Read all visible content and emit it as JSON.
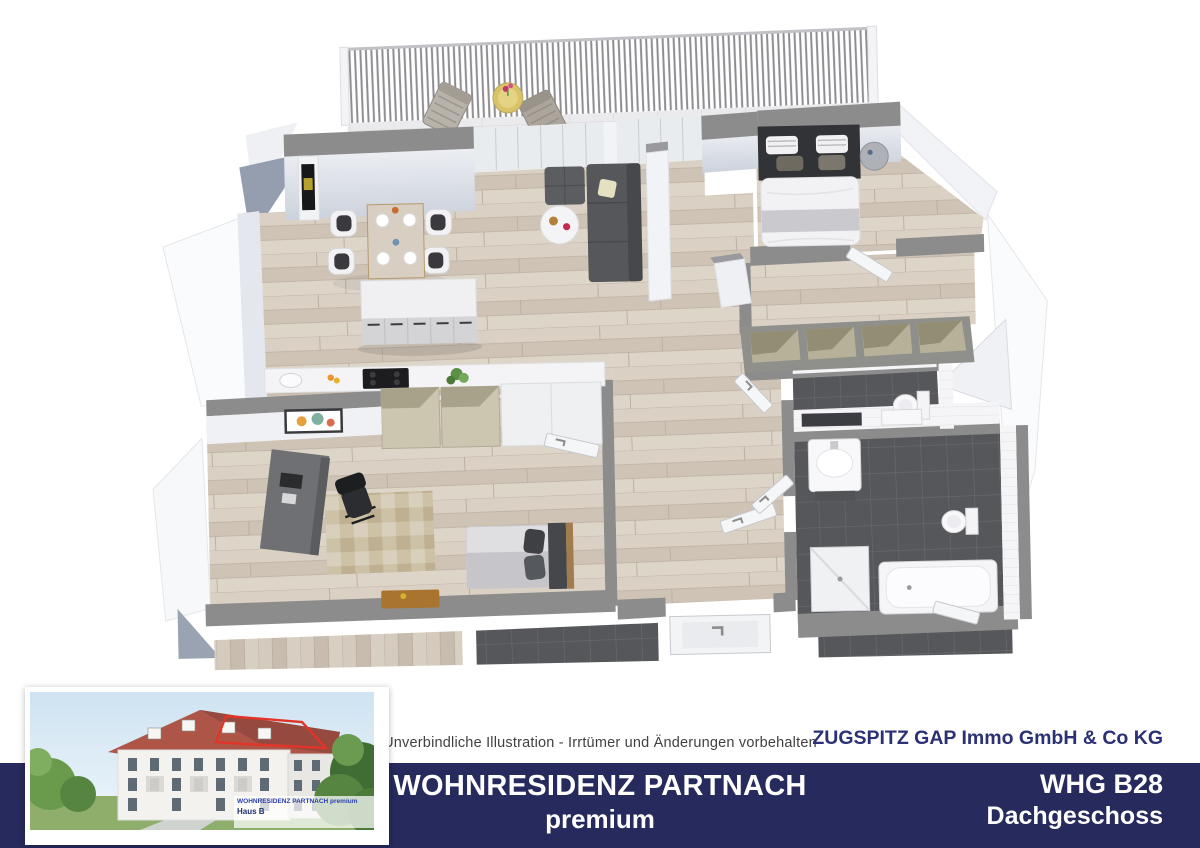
{
  "footer": {
    "disclaimer": "Unverbindliche Illustration - Irrtümer und Änderungen vorbehalten",
    "company": "ZUGSPITZ GAP Immo GmbH & Co KG",
    "project_title": "WOHNRESIDENZ PARTNACH",
    "project_subtitle": "premium",
    "unit": "WHG B28",
    "floor": "Dachgeschoss"
  },
  "inset": {
    "type": "building-exterior-rendering",
    "highlight": "penthouse-roof-red-outline",
    "caption_line1": "WOHNRESIDENZ PARTNACH premium",
    "caption_line2": "Haus B"
  },
  "floor_plan": {
    "type": "3d-floor-plan-top-view",
    "rooms": [
      {
        "name": "terrace"
      },
      {
        "name": "living-dining-room"
      },
      {
        "name": "kitchen"
      },
      {
        "name": "bedroom"
      },
      {
        "name": "dressing-room"
      },
      {
        "name": "wc"
      },
      {
        "name": "bathroom"
      },
      {
        "name": "office-guest-room"
      },
      {
        "name": "hallway"
      },
      {
        "name": "loggia"
      }
    ],
    "furniture": [
      "railing",
      "deck-chair",
      "deck-chair",
      "terrace-table",
      "tv-sideboard",
      "dining-table",
      "dining-chairs",
      "kitchen-island",
      "kitchen-counter",
      "cooktop",
      "open-cabinets",
      "tall-cabinet",
      "wall-art",
      "sofa",
      "ottoman",
      "coffee-table",
      "double-bed",
      "bedside-table",
      "open-wardrobe",
      "washbasin",
      "mirror",
      "toilet",
      "toilet",
      "shower",
      "bathtub",
      "desk",
      "office-chair",
      "rug",
      "guest-bed",
      "wooden-bench",
      "entrance-door",
      "interior-doors"
    ]
  },
  "colors": {
    "navy_bar": "#262a5c",
    "company_text": "#2b3175",
    "title_text": "#ffffff",
    "disclaimer_text": "#414141",
    "red_highlight": "#e03528",
    "wall_gray": "#8c8c8c",
    "wall_face": "#dfe3ea",
    "wood_floor": "#d6ccc0",
    "dark_tile": "#55575b",
    "terrace_tile": "#ebebee",
    "sofa_gray": "#55575a",
    "roof_blue_gray": "#949eae"
  }
}
